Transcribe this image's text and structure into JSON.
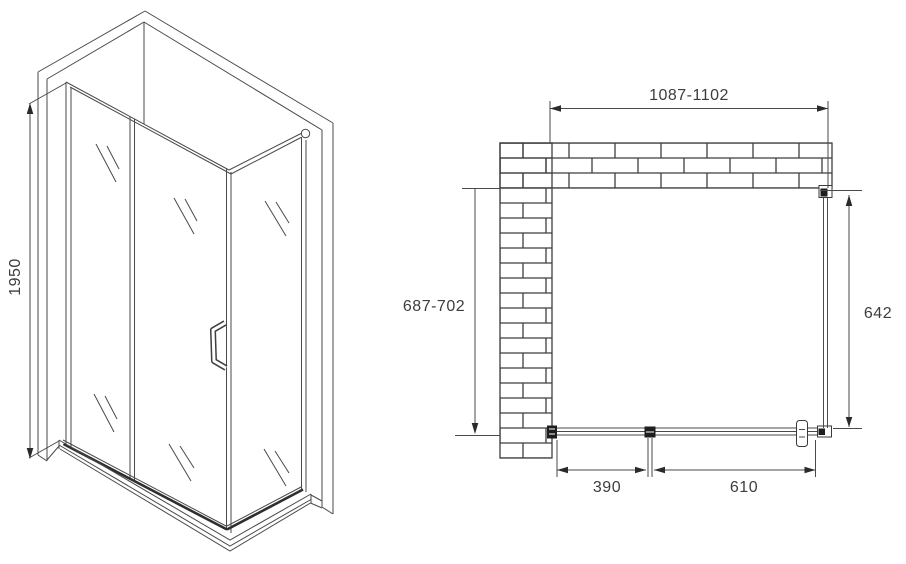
{
  "diagram": {
    "subject": "shower-enclosure-technical-drawing",
    "background_color": "#ffffff",
    "line_color": "#4a4a4a",
    "text_color": "#3d3d3d",
    "side_view": {
      "height": "1950"
    },
    "plan_view": {
      "width": "1087-1102",
      "depth": "687-702",
      "side_panel": "642",
      "section_left": "390",
      "section_right": "610"
    }
  }
}
